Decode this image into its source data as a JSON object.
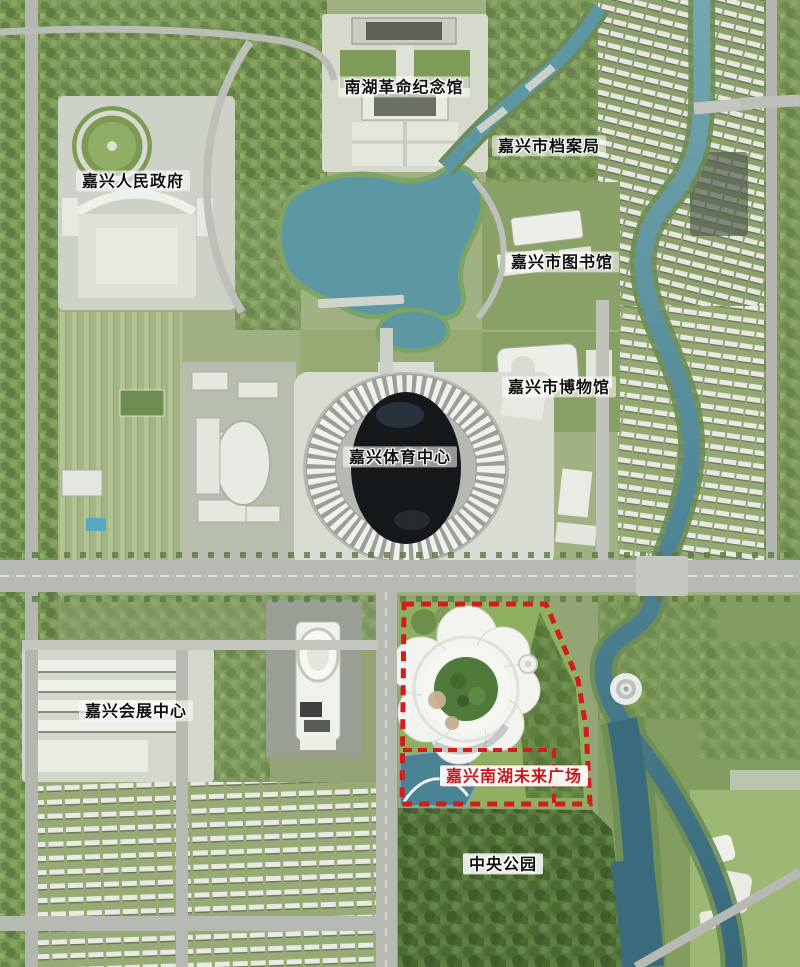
{
  "labels": [
    {
      "id": "nanhu-revolution-memorial",
      "text": "南湖革命纪念馆",
      "color": "#101010"
    },
    {
      "id": "city-archives-bureau",
      "text": "嘉兴市档案局",
      "color": "#101010"
    },
    {
      "id": "people-government",
      "text": "嘉兴人民政府",
      "color": "#101010"
    },
    {
      "id": "city-library",
      "text": "嘉兴市图书馆",
      "color": "#101010"
    },
    {
      "id": "city-museum",
      "text": "嘉兴市博物馆",
      "color": "#101010"
    },
    {
      "id": "sports-center",
      "text": "嘉兴体育中心",
      "color": "#101010"
    },
    {
      "id": "convention-center",
      "text": "嘉兴会展中心",
      "color": "#101010"
    },
    {
      "id": "nanhu-future-plaza",
      "text": "嘉兴南湖未来广场",
      "color": "#c5191f"
    },
    {
      "id": "central-park",
      "text": "中央公园",
      "color": "#101010"
    }
  ],
  "map": {
    "type": "aerial-photo",
    "site_boundary_color": "#d31d1d",
    "lake_color": "#5e97a4",
    "river_color": "#3a6b7c",
    "vegetation_color": "#8fb061",
    "park_tree_color": "#55763c",
    "road_color": "#b6bab2",
    "stadium_roof_color": "#15181a",
    "features": [
      "lake",
      "river",
      "stadium-dome",
      "flower-building",
      "site-boundary",
      "ring-pavilion",
      "residential-rows",
      "central-park-trees"
    ]
  }
}
